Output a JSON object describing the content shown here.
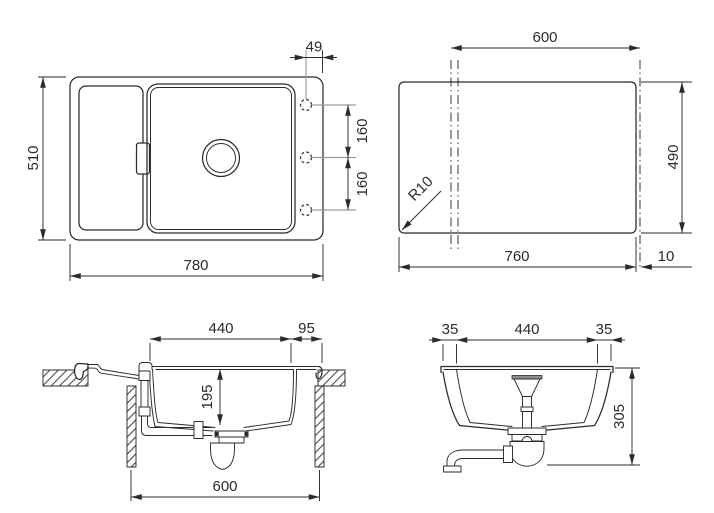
{
  "views": {
    "plan": {
      "overall_width": "780",
      "overall_depth": "510",
      "hole_edge_offset": "49",
      "hole_spacing_1": "160",
      "hole_spacing_2": "160"
    },
    "cutout": {
      "reference_width": "600",
      "height": "490",
      "width": "760",
      "edge_offset": "10",
      "corner_radius": "R10"
    },
    "side": {
      "bowl_length": "440",
      "edge_distance": "95",
      "bowl_depth": "195",
      "cabinet_width": "600"
    },
    "front": {
      "offset_left": "35",
      "bowl_width": "440",
      "offset_right": "35",
      "overall_depth": "305"
    }
  },
  "colors": {
    "line": "#2b2b2b",
    "centerline": "#9b9b9b",
    "background": "#ffffff"
  }
}
